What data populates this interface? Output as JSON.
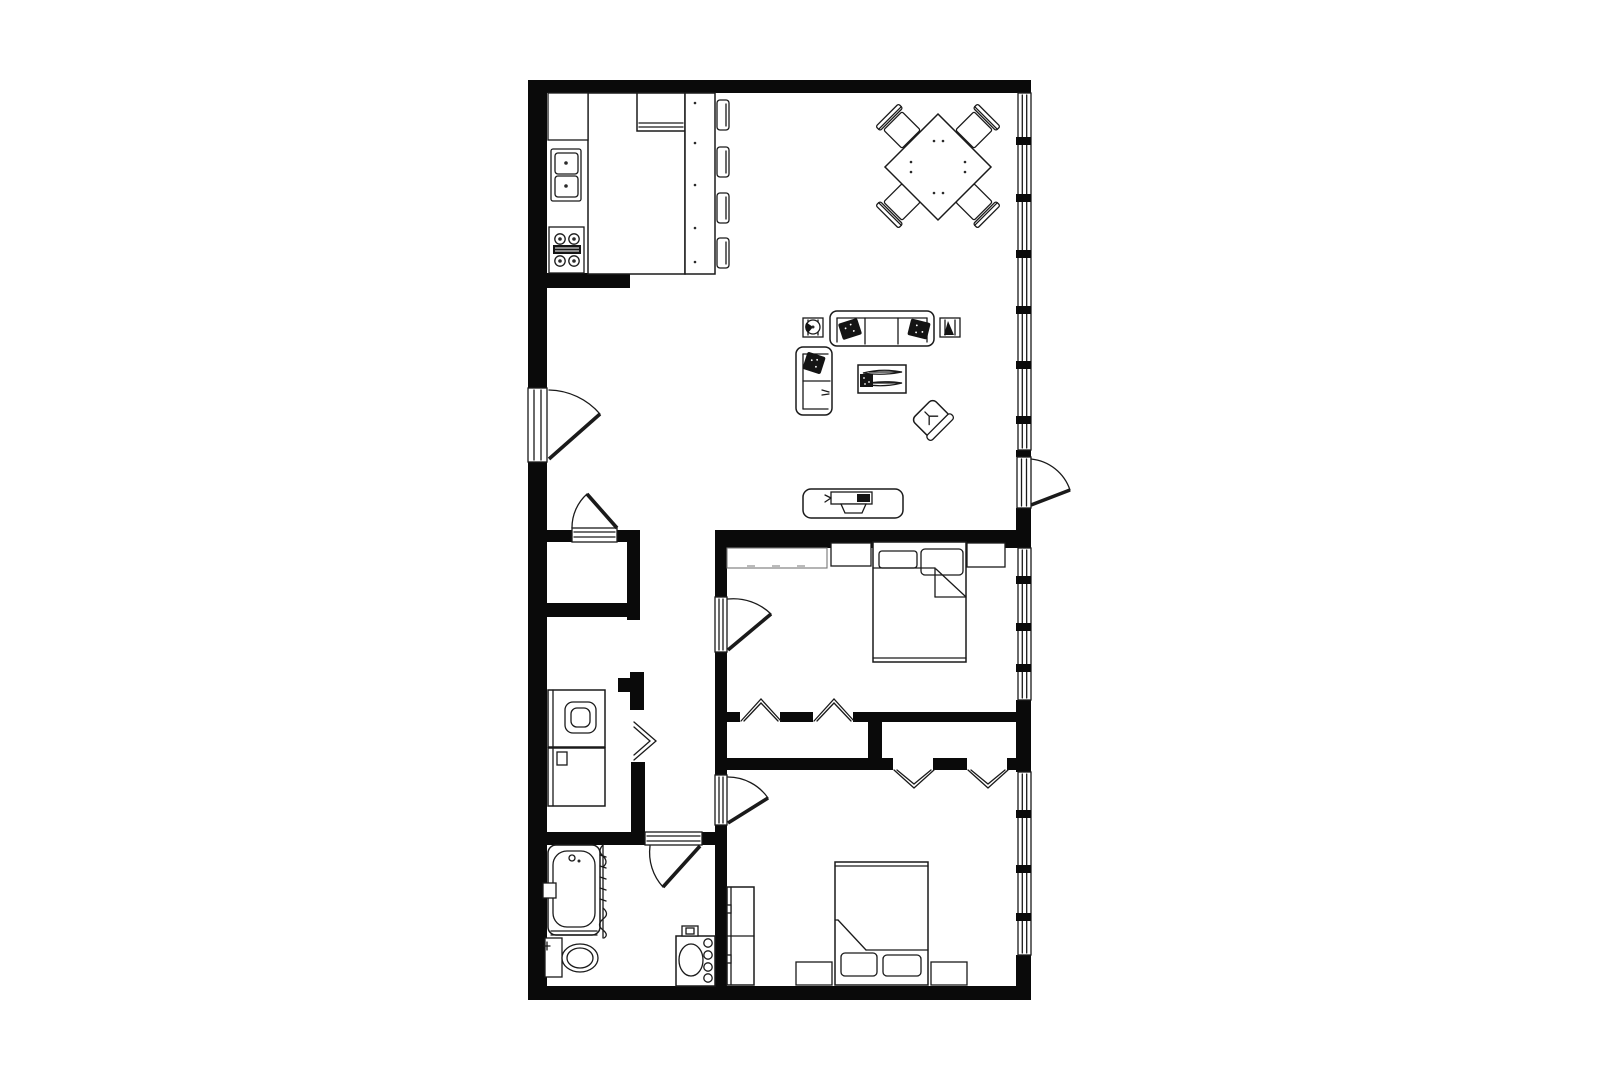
{
  "page": {
    "background": "#ffffff",
    "content": "black-and-white architectural floor plan of a two-bedroom apartment, no text labels rendered"
  },
  "palette": {
    "walls": "#0a0a0a",
    "lines": "#1a1a1a",
    "light_lines": "#777777",
    "fill": "#ffffff",
    "dark_fill": "#141414"
  },
  "rooms": [
    {
      "id": "kitchen",
      "label": "kitchen (top left)",
      "contents": [
        "wall-cabinet",
        "double-bowl-sink",
        "range-4-burners",
        "cross-hatched-counter",
        "refrigerator",
        "breakfast-bar",
        "bar-stool x4"
      ]
    },
    {
      "id": "dining-area",
      "label": "dining area (top right)",
      "contents": [
        "square-table-rotated-45deg",
        "dining-chair x4"
      ]
    },
    {
      "id": "living-room",
      "label": "living room (center right)",
      "contents": [
        "three-seat-sofa",
        "dark-throw-pillow x3",
        "loveseat",
        "side-table x2",
        "potted-plant",
        "coffee-table with magazines",
        "armchair-rotated-45deg",
        "tv-console",
        "television"
      ]
    },
    {
      "id": "entry-hall",
      "label": "entry hall and corridor (left center)",
      "contents": [
        "entry-door",
        "hall-closet x2"
      ]
    },
    {
      "id": "laundry-closet",
      "label": "laundry closet",
      "contents": [
        "washer",
        "dryer",
        "bifold-door"
      ]
    },
    {
      "id": "bathroom",
      "label": "bathroom (bottom left)",
      "contents": [
        "bathtub",
        "shower-curtain",
        "toilet",
        "vanity-sink",
        "soap-dish"
      ]
    },
    {
      "id": "bedroom-1",
      "label": "bedroom 1 (middle right)",
      "contents": [
        "double-bed",
        "pillow x2",
        "nightstand x2",
        "dresser",
        "closet with bifold doors x2"
      ]
    },
    {
      "id": "bedroom-2",
      "label": "bedroom 2 (bottom right)",
      "contents": [
        "double-bed",
        "pillow x2",
        "nightstand x2",
        "wardrobe",
        "closet with bifold doors x2"
      ]
    }
  ],
  "doors": [
    {
      "id": "entry-door",
      "type": "hinged",
      "wall": "left exterior",
      "swing": "into entry hall"
    },
    {
      "id": "balcony-door",
      "type": "hinged",
      "wall": "right exterior",
      "swing": "outward"
    },
    {
      "id": "hall-closet-door",
      "type": "hinged",
      "swing": "into hall"
    },
    {
      "id": "laundry-bifold-door",
      "type": "bifold"
    },
    {
      "id": "bedroom-1-door",
      "type": "hinged",
      "swing": "into bedroom 1"
    },
    {
      "id": "bedroom-2-door",
      "type": "hinged",
      "swing": "into bedroom 2"
    },
    {
      "id": "bathroom-door",
      "type": "hinged",
      "swing": "into bathroom"
    },
    {
      "id": "bedroom-1-closet-doors",
      "type": "bifold",
      "count": 2
    },
    {
      "id": "bedroom-2-closet-doors",
      "type": "bifold",
      "count": 2
    }
  ],
  "windows": {
    "wall": "right exterior",
    "living_room_panes": 7,
    "bedroom_1_panes": 4,
    "bedroom_2_panes": 4,
    "balcony_door_between": "living room windows and bedroom 1 windows"
  }
}
